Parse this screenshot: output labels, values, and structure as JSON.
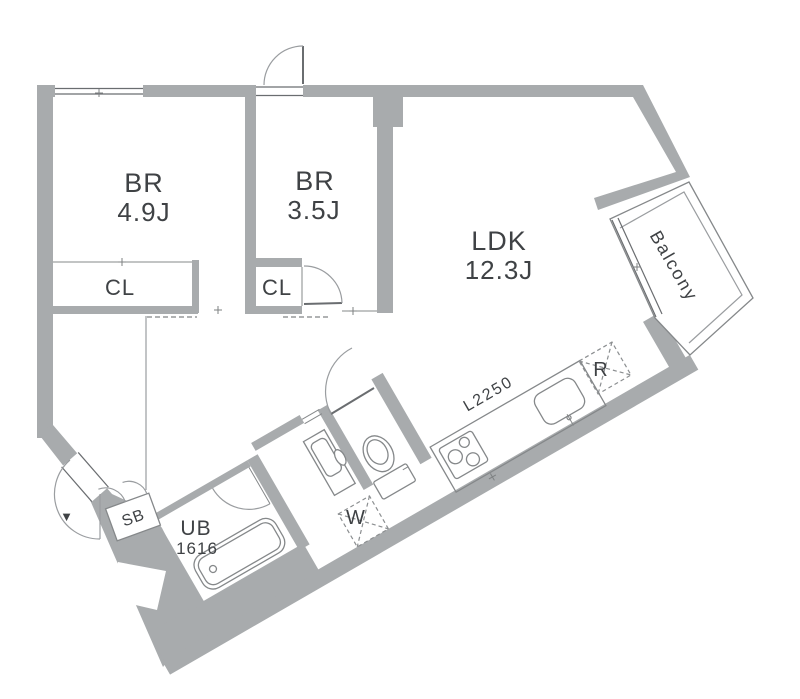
{
  "plan": {
    "colors": {
      "wall": "#a8abad",
      "line": "#85888a",
      "dark_line": "#6a6d70",
      "dashed": "#95989a",
      "text": "#3f4245",
      "background": "#ffffff"
    },
    "rooms": {
      "br1": {
        "name": "BR",
        "size": "4.9J"
      },
      "br2": {
        "name": "BR",
        "size": "3.5J"
      },
      "ldk": {
        "name": "LDK",
        "size": "12.3J"
      },
      "cl1": {
        "label": "CL"
      },
      "cl2": {
        "label": "CL"
      },
      "balcony": {
        "label": "Balcony"
      },
      "unit_bath": {
        "label": "UB",
        "size": "1616"
      },
      "shoe_box": {
        "label": "SB"
      },
      "washer": {
        "label": "W"
      },
      "refrigerator": {
        "label": "R"
      },
      "kitchen_counter": {
        "label": "L2250"
      }
    },
    "markers": {
      "entrance": "▼"
    }
  }
}
